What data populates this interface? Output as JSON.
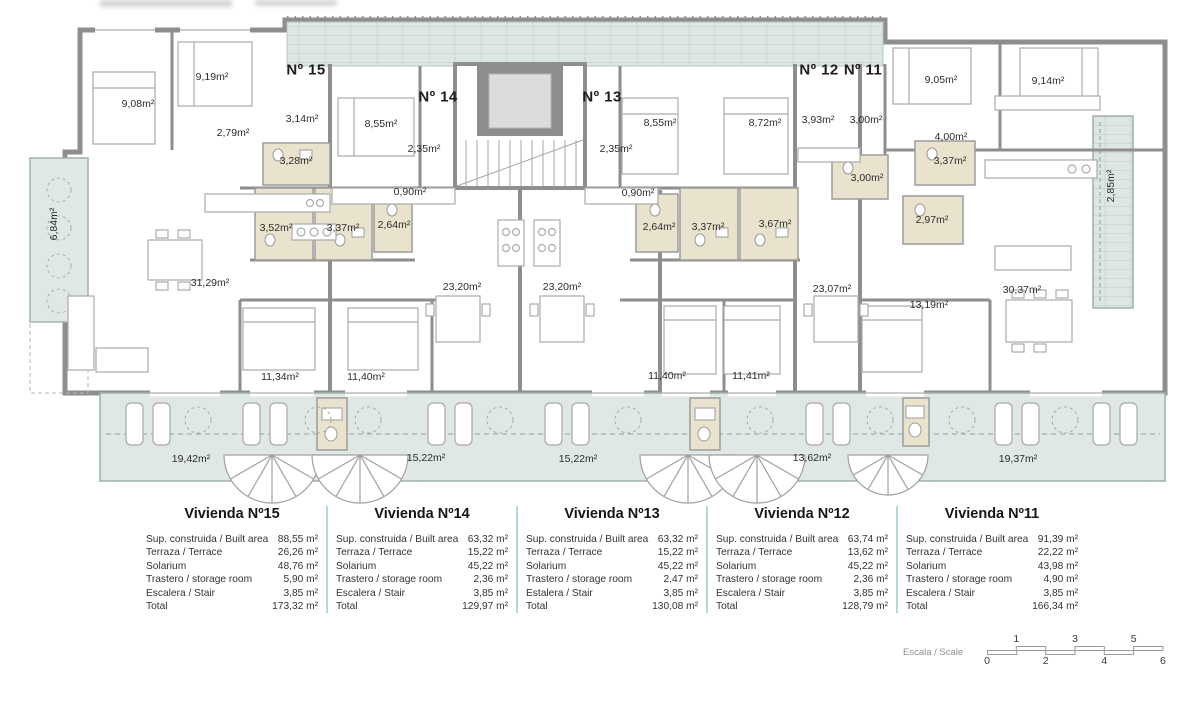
{
  "plan": {
    "apartment_labels": [
      {
        "text": "Nº 15",
        "x": 306,
        "y": 70
      },
      {
        "text": "Nº 14",
        "x": 438,
        "y": 97
      },
      {
        "text": "Nº 13",
        "x": 602,
        "y": 97
      },
      {
        "text": "Nº 12",
        "x": 819,
        "y": 70
      },
      {
        "text": "Nº 11",
        "x": 863,
        "y": 70
      }
    ],
    "room_labels": [
      {
        "text": "9,19m²",
        "x": 212,
        "y": 77
      },
      {
        "text": "9,08m²",
        "x": 138,
        "y": 104
      },
      {
        "text": "3,14m²",
        "x": 302,
        "y": 119
      },
      {
        "text": "8,55m²",
        "x": 381,
        "y": 124
      },
      {
        "text": "2,79m²",
        "x": 233,
        "y": 133
      },
      {
        "text": "2,35m²",
        "x": 424,
        "y": 149
      },
      {
        "text": "2,35m²",
        "x": 616,
        "y": 149
      },
      {
        "text": "3,28m²",
        "x": 296,
        "y": 161
      },
      {
        "text": "8,55m²",
        "x": 660,
        "y": 123
      },
      {
        "text": "8,72m²",
        "x": 765,
        "y": 123
      },
      {
        "text": "3,93m²",
        "x": 818,
        "y": 120
      },
      {
        "text": "3,00m²",
        "x": 866,
        "y": 120
      },
      {
        "text": "9,05m²",
        "x": 941,
        "y": 80
      },
      {
        "text": "9,14m²",
        "x": 1048,
        "y": 81
      },
      {
        "text": "4,00m²",
        "x": 951,
        "y": 137
      },
      {
        "text": "3,37m²",
        "x": 950,
        "y": 161
      },
      {
        "text": "3,00m²",
        "x": 867,
        "y": 178
      },
      {
        "text": "0,90m²",
        "x": 410,
        "y": 192
      },
      {
        "text": "0,90m²",
        "x": 638,
        "y": 193
      },
      {
        "text": "3,52m²",
        "x": 276,
        "y": 228
      },
      {
        "text": "3,37m²",
        "x": 343,
        "y": 228
      },
      {
        "text": "2,64m²",
        "x": 394,
        "y": 225
      },
      {
        "text": "2,64m²",
        "x": 659,
        "y": 227
      },
      {
        "text": "3,37m²",
        "x": 708,
        "y": 227
      },
      {
        "text": "3,67m²",
        "x": 775,
        "y": 224
      },
      {
        "text": "2,97m²",
        "x": 932,
        "y": 220
      },
      {
        "text": "31,29m²",
        "x": 210,
        "y": 283
      },
      {
        "text": "23,20m²",
        "x": 462,
        "y": 287
      },
      {
        "text": "23,20m²",
        "x": 562,
        "y": 287
      },
      {
        "text": "23,07m²",
        "x": 832,
        "y": 289
      },
      {
        "text": "13,19m²",
        "x": 929,
        "y": 305
      },
      {
        "text": "30,37m²",
        "x": 1022,
        "y": 290
      },
      {
        "text": "11,34m²",
        "x": 280,
        "y": 377
      },
      {
        "text": "11,40m²",
        "x": 366,
        "y": 377
      },
      {
        "text": "11,40m²",
        "x": 667,
        "y": 376
      },
      {
        "text": "11,41m²",
        "x": 751,
        "y": 376
      },
      {
        "text": "19,42m²",
        "x": 191,
        "y": 459
      },
      {
        "text": "15,22m²",
        "x": 426,
        "y": 458
      },
      {
        "text": "15,22m²",
        "x": 578,
        "y": 459
      },
      {
        "text": "13,62m²",
        "x": 812,
        "y": 458
      },
      {
        "text": "19,37m²",
        "x": 1018,
        "y": 459
      }
    ],
    "vertical_labels": [
      {
        "text": "6,84m²",
        "x": 54,
        "y": 224
      },
      {
        "text": "2,85m²",
        "x": 1111,
        "y": 186
      }
    ]
  },
  "tables": [
    {
      "title": "Vivienda Nº15",
      "rows": [
        [
          "Sup. construida / Built area",
          "88,55 m²"
        ],
        [
          "Terraza / Terrace",
          "26,26 m²"
        ],
        [
          "Solarium",
          "48,76 m²"
        ],
        [
          "Trastero / storage room",
          "5,90 m²"
        ],
        [
          "Escalera / Stair",
          "3,85 m²"
        ],
        [
          "Total",
          "173,32 m²"
        ]
      ]
    },
    {
      "title": "Vivienda Nº14",
      "rows": [
        [
          "Sup. construida / Built area",
          "63,32 m²"
        ],
        [
          "Terraza / Terrace",
          "15,22 m²"
        ],
        [
          "Solarium",
          "45,22 m²"
        ],
        [
          "Trastero / storage room",
          "2,36 m²"
        ],
        [
          "Escalera / Stair",
          "3,85 m²"
        ],
        [
          "Total",
          "129,97 m²"
        ]
      ]
    },
    {
      "title": "Vivienda Nº13",
      "rows": [
        [
          "Sup. construida / Built area",
          "63,32 m²"
        ],
        [
          "Terraza / Terrace",
          "15,22 m²"
        ],
        [
          "Solarium",
          "45,22 m²"
        ],
        [
          "Trastero / storage room",
          "2,47 m²"
        ],
        [
          "Estalera / Stair",
          "3,85 m²"
        ],
        [
          "Total",
          "130,08 m²"
        ]
      ]
    },
    {
      "title": "Vivienda Nº12",
      "rows": [
        [
          "Sup. construida / Built area",
          "63,74 m²"
        ],
        [
          "Terraza / Terrace",
          "13,62 m²"
        ],
        [
          "Solarium",
          "45,22 m²"
        ],
        [
          "Trastero / storage room",
          "2,36 m²"
        ],
        [
          "Escalera / Stair",
          "3,85 m²"
        ],
        [
          "Total",
          "128,79 m²"
        ]
      ]
    },
    {
      "title": "Vivienda Nº11",
      "rows": [
        [
          "Sup. construida / Built area",
          "91,39 m²"
        ],
        [
          "Terraza / Terrace",
          "22,22 m²"
        ],
        [
          "Solarium",
          "43,98 m²"
        ],
        [
          "Trastero / storage room",
          "4,90 m²"
        ],
        [
          "Escalera / Stair",
          "3,85 m²"
        ],
        [
          "Total",
          "166,34 m²"
        ]
      ]
    }
  ],
  "scale": {
    "label": "Escala / Scale",
    "top_numbers": [
      "1",
      "3",
      "5"
    ],
    "bottom_numbers": [
      "0",
      "2",
      "4",
      "6"
    ]
  }
}
